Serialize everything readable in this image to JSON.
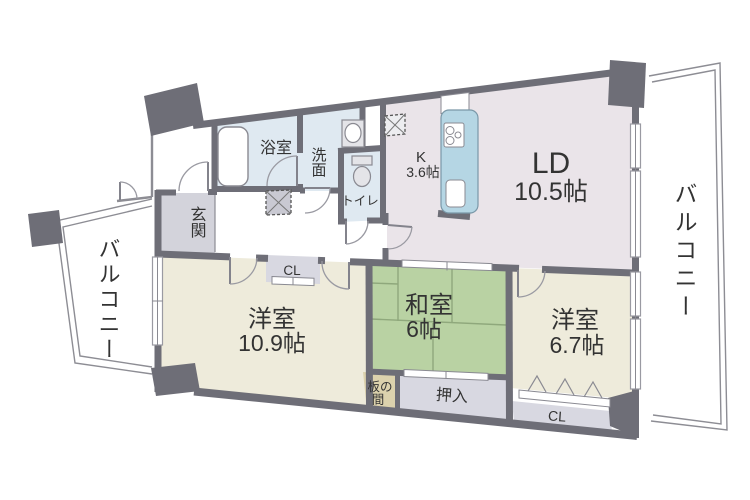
{
  "colors": {
    "wall": "#6e6e77",
    "room_ld": "#eae4e9",
    "room_water": "#dfe9f1",
    "room_western": "#eeebdb",
    "room_tatami": "#b9d2a3",
    "tatami_line": "#8fa87c",
    "room_itanoma": "#dcd2ad",
    "room_closet": "#d8d8e1",
    "room_genkan": "#d3d3db",
    "counter": "#b5d6e4",
    "balcony_line": "#8d8d94",
    "text": "#333333"
  },
  "labels": {
    "bath": "浴室",
    "washroom": "洗面",
    "toilet": "トイレ",
    "genkan": "玄関",
    "kitchen_name": "K",
    "kitchen_size": "3.6帖",
    "living_name": "LD",
    "living_size": "10.5帖",
    "western1_name": "洋室",
    "western1_size": "10.9帖",
    "japanese_name": "和室",
    "japanese_size": "6帖",
    "western2_name": "洋室",
    "western2_size": "6.7帖",
    "itanoma_line1": "板の",
    "itanoma_line2": "間",
    "oshiire": "押入",
    "closet_hall": "CL",
    "closet_west2": "CL",
    "balcony_left": "バルコニー",
    "balcony_right": "バルコニー"
  }
}
